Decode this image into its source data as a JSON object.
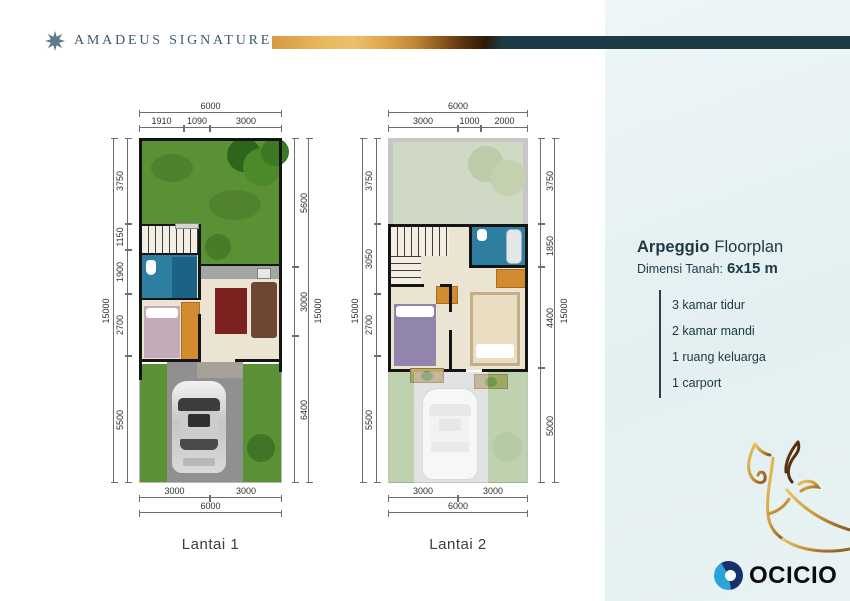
{
  "header": {
    "brand": "AMADEUS SIGNATURE",
    "logo_icon": "snowflake-medallion-icon"
  },
  "info": {
    "title_bold": "Arpeggio",
    "title_rest": "Floorplan",
    "land_label": "Dimensi Tanah:",
    "land_value": "6x15 m",
    "features": [
      "3 kamar tidur",
      "2 kamar mandi",
      "1 ruang keluarga",
      "1 carport"
    ]
  },
  "plans": [
    {
      "label": "Lantai 1",
      "dims": {
        "top_total": "6000",
        "top_segments": [
          "1910",
          "1090",
          "3000"
        ],
        "left_total": "15000",
        "left_segments": [
          "3750",
          "1150",
          "1900",
          "2700",
          "5500"
        ],
        "right_total": "15000",
        "right_segments": [
          "5600",
          "3000",
          "6400"
        ],
        "bottom_total": "6000",
        "bottom_segments": [
          "3000",
          "3000"
        ]
      }
    },
    {
      "label": "Lantai 2",
      "dims": {
        "top_total": "6000",
        "top_segments": [
          "3000",
          "1000",
          "2000"
        ],
        "left_total": "15000",
        "left_segments": [
          "3750",
          "3050",
          "2700",
          "5500"
        ],
        "right_total": "15000",
        "right_segments": [
          "3750",
          "1850",
          "4400",
          "5000"
        ],
        "bottom_total": "6000",
        "bottom_segments": [
          "3000",
          "3000"
        ]
      }
    }
  ],
  "footer": {
    "logo_text": "OCICIO",
    "logo_icon": "ocicio-eye-icon",
    "artwork_icon": "deer-line-art-icon"
  },
  "colors": {
    "accent_teal": "#1c3b46",
    "gold": "#d79a42",
    "panel_bg": "#e7f1f3",
    "grass": "#5a9134",
    "wall": "#141414",
    "bathroom_blue": "#2d7ea0"
  }
}
